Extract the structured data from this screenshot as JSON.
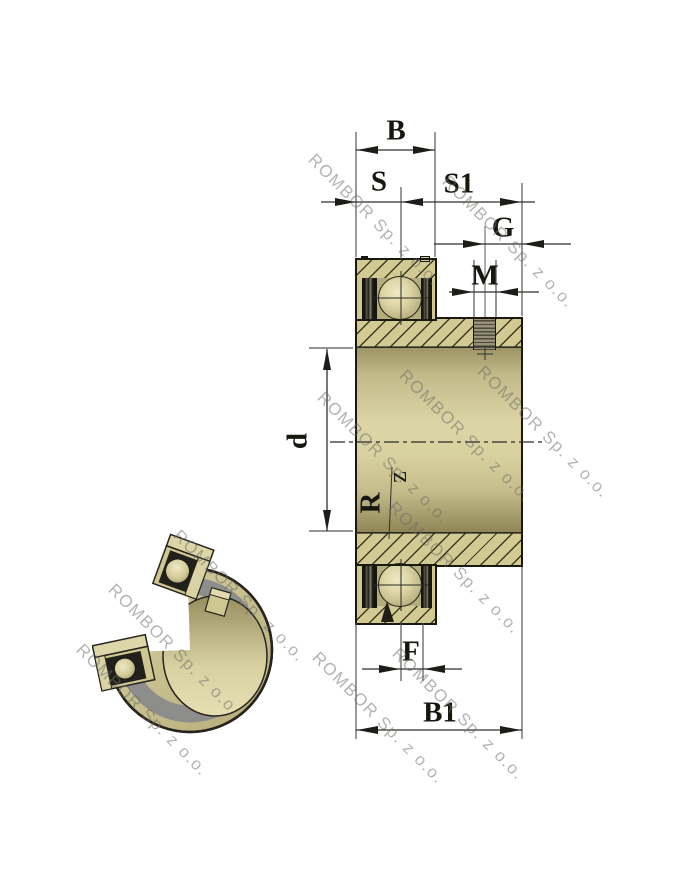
{
  "drawing": {
    "description": "Insert ball bearing cross-section drawing with 3D cutaway view",
    "labels": {
      "b": "B",
      "s": "S",
      "s1": "S1",
      "g": "G",
      "m": "M",
      "d": "d",
      "r": "R",
      "z": "z",
      "f": "F",
      "b1": "B1"
    }
  },
  "watermark": {
    "text": "ROMBOR Sp. z o.o."
  },
  "colors": {
    "body_khaki": "#d2ca93",
    "body_light": "#dcd6a7",
    "hatch_line": "#2d2a18",
    "seal_dark": "#15140f",
    "thread_gray": "#97917c",
    "gray_band_3d": "#8d8d8b",
    "dimension_line": "#2f2f2a",
    "label_color": "#17170f",
    "watermark_gray": "#696964",
    "background": "#ffffff"
  }
}
